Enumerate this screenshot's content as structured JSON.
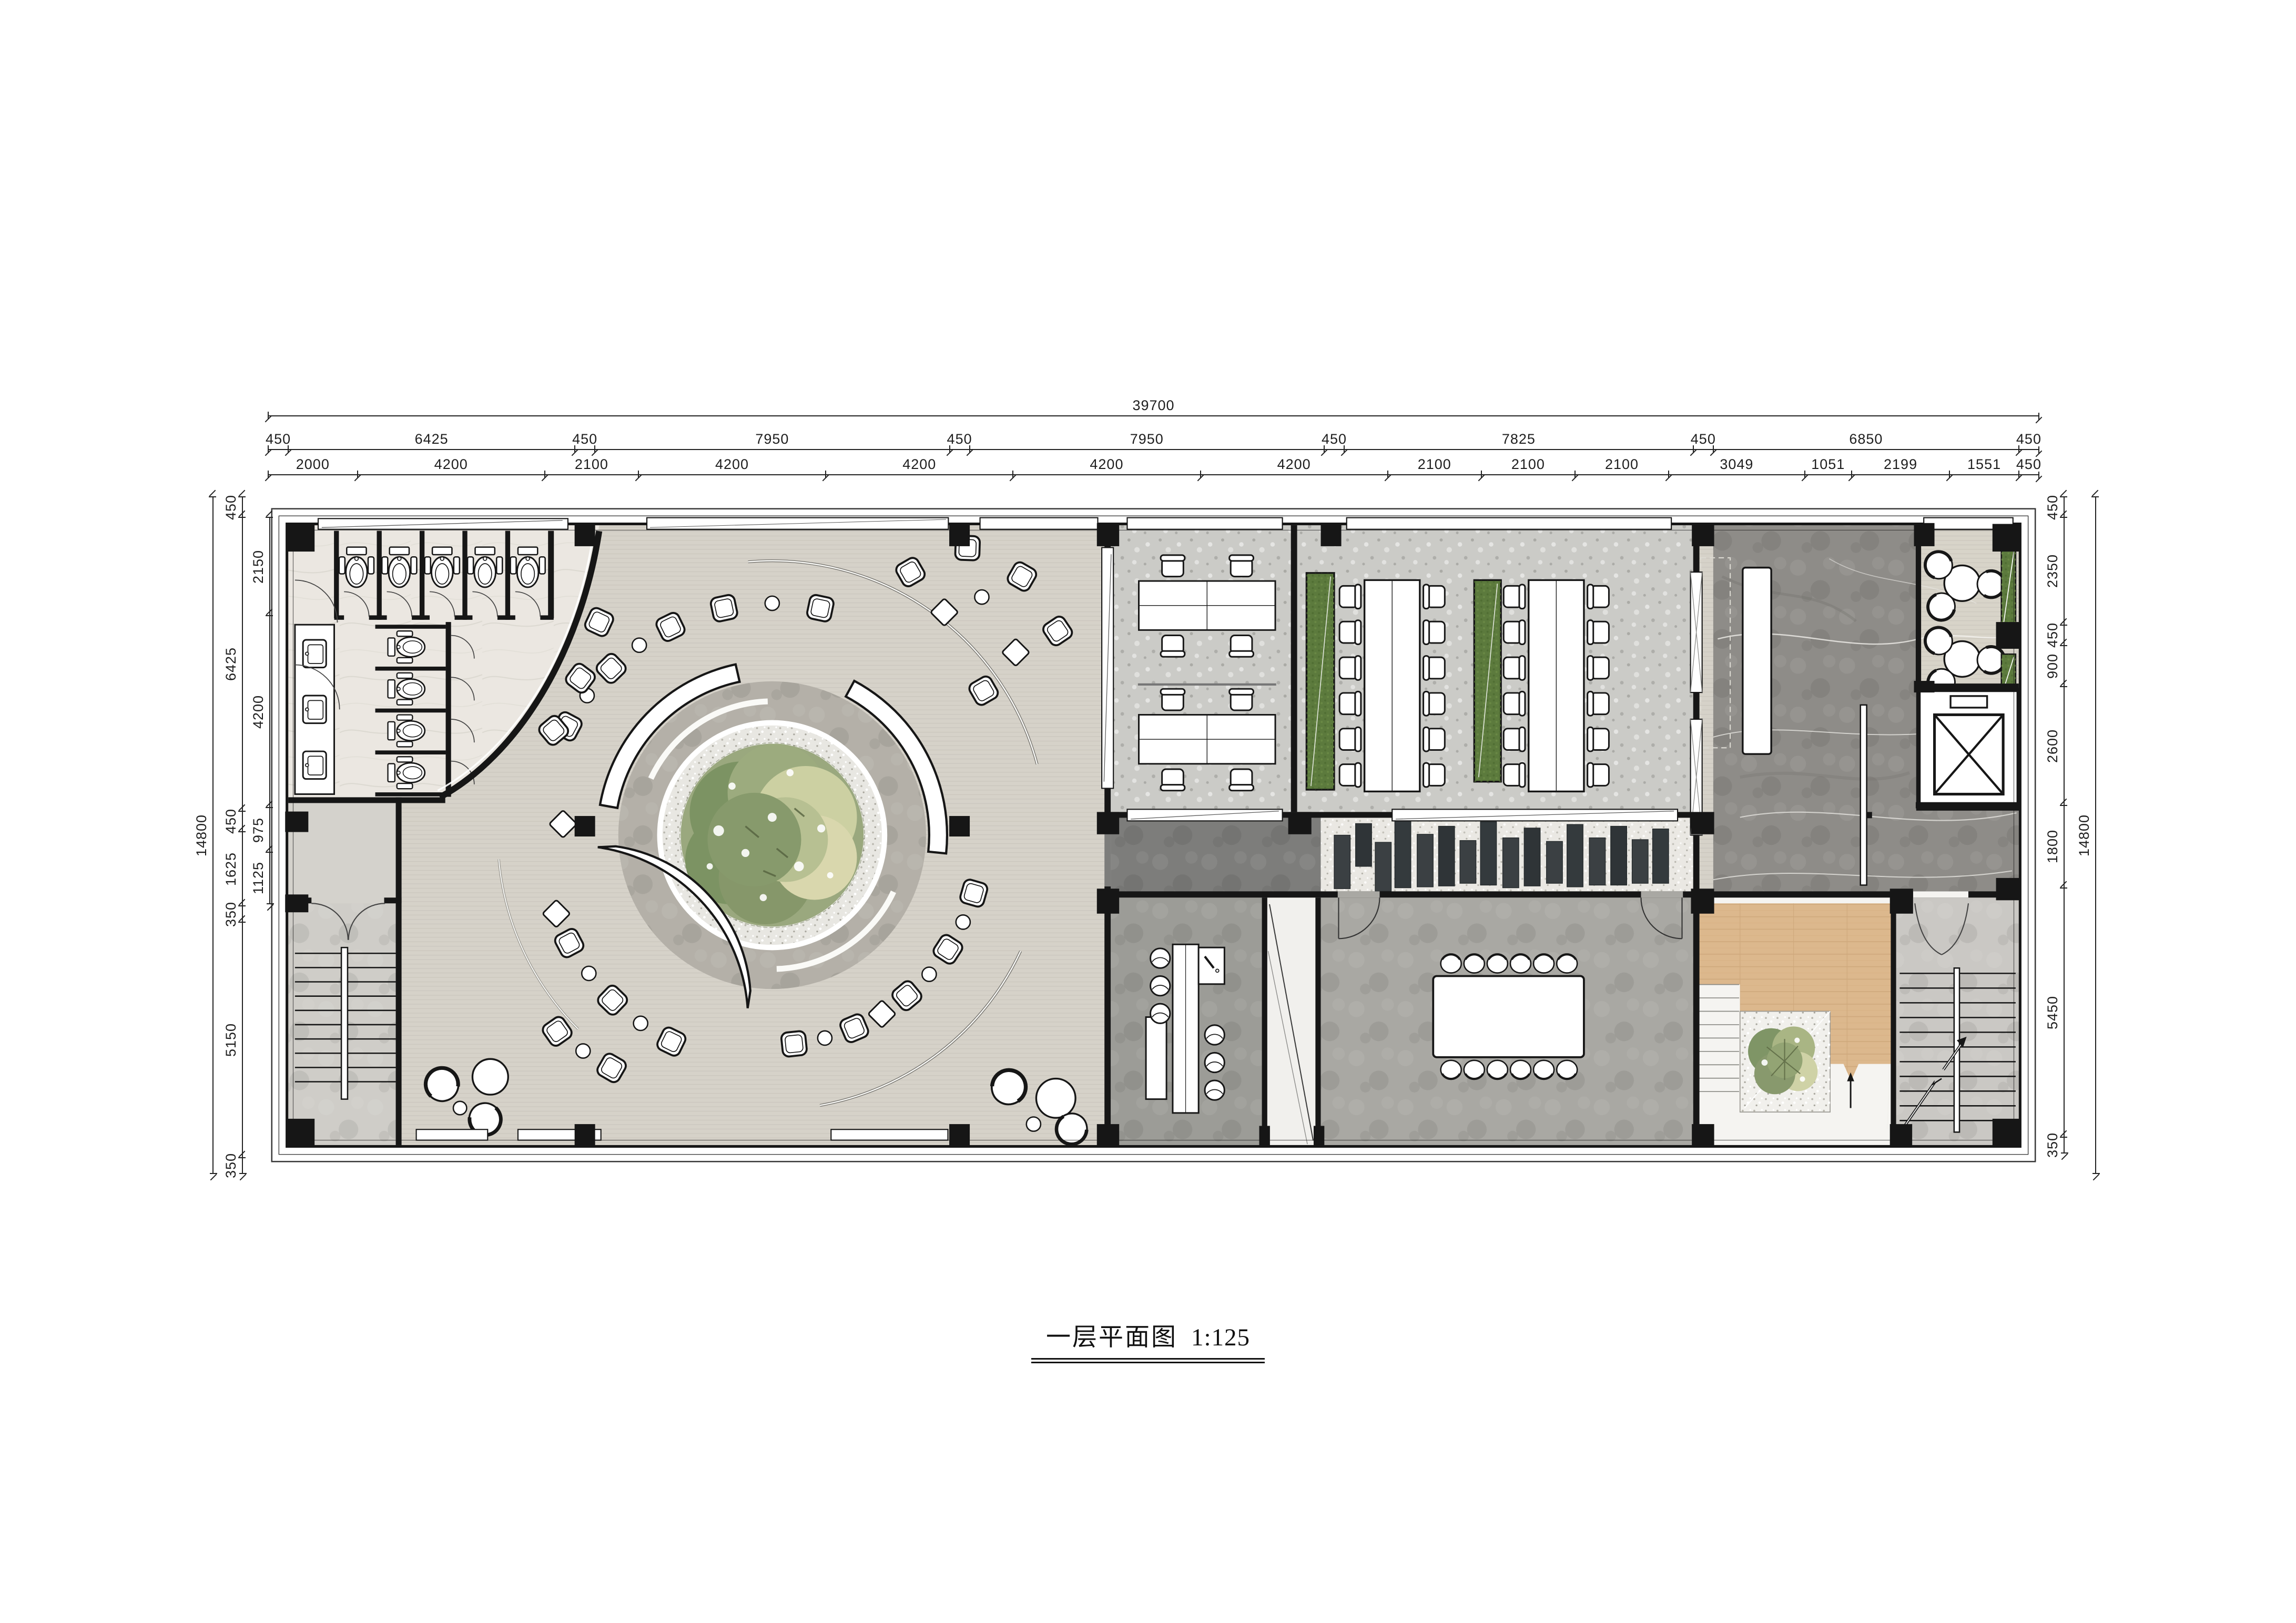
{
  "title": {
    "text": "一层平面图",
    "scale": "1:125"
  },
  "dimensions": {
    "top": {
      "total": "39700",
      "grid": [
        "450",
        "6425",
        "450",
        "7950",
        "450",
        "7950",
        "450",
        "7825",
        "450",
        "6850",
        "450"
      ],
      "detail": [
        "2000",
        "4200",
        "2100",
        "4200",
        "4200",
        "4200",
        "4200",
        "2100",
        "2100",
        "2100",
        "3049",
        "1051",
        "2199",
        "1551",
        "450"
      ]
    },
    "left": {
      "total": "14800",
      "main": [
        "450",
        "6425",
        "450",
        "1625",
        "350",
        "5150",
        "350"
      ],
      "inner": [
        "2150",
        "4200",
        "975",
        "1125"
      ]
    },
    "right": {
      "total": "14800",
      "main": [
        "450",
        "2350",
        "450",
        "900",
        "2600",
        "1800",
        "5450",
        "350"
      ]
    }
  },
  "colors": {
    "wall": "#161616",
    "hall": "#d6d2c9",
    "restroom": "#ebe7e1",
    "terrazzo": "#cbcbc7",
    "corridor": "#7d7d7b",
    "pebble": "#eae8e3",
    "slate": "#3b4043",
    "bar": "#9c9c97",
    "vestibule": "#f1f0ed",
    "meeting": "#a9a8a3",
    "marble": "#8e8c88",
    "nook": "#d8d4c9",
    "planter": "#5c7a3d",
    "wood": "#dcb88d",
    "stair": "#cac8c4",
    "stairleft": "#cfcdc8",
    "ring": "#b4b0a8",
    "gravel": "#e8e7e2",
    "furniture": "#ffffff"
  }
}
